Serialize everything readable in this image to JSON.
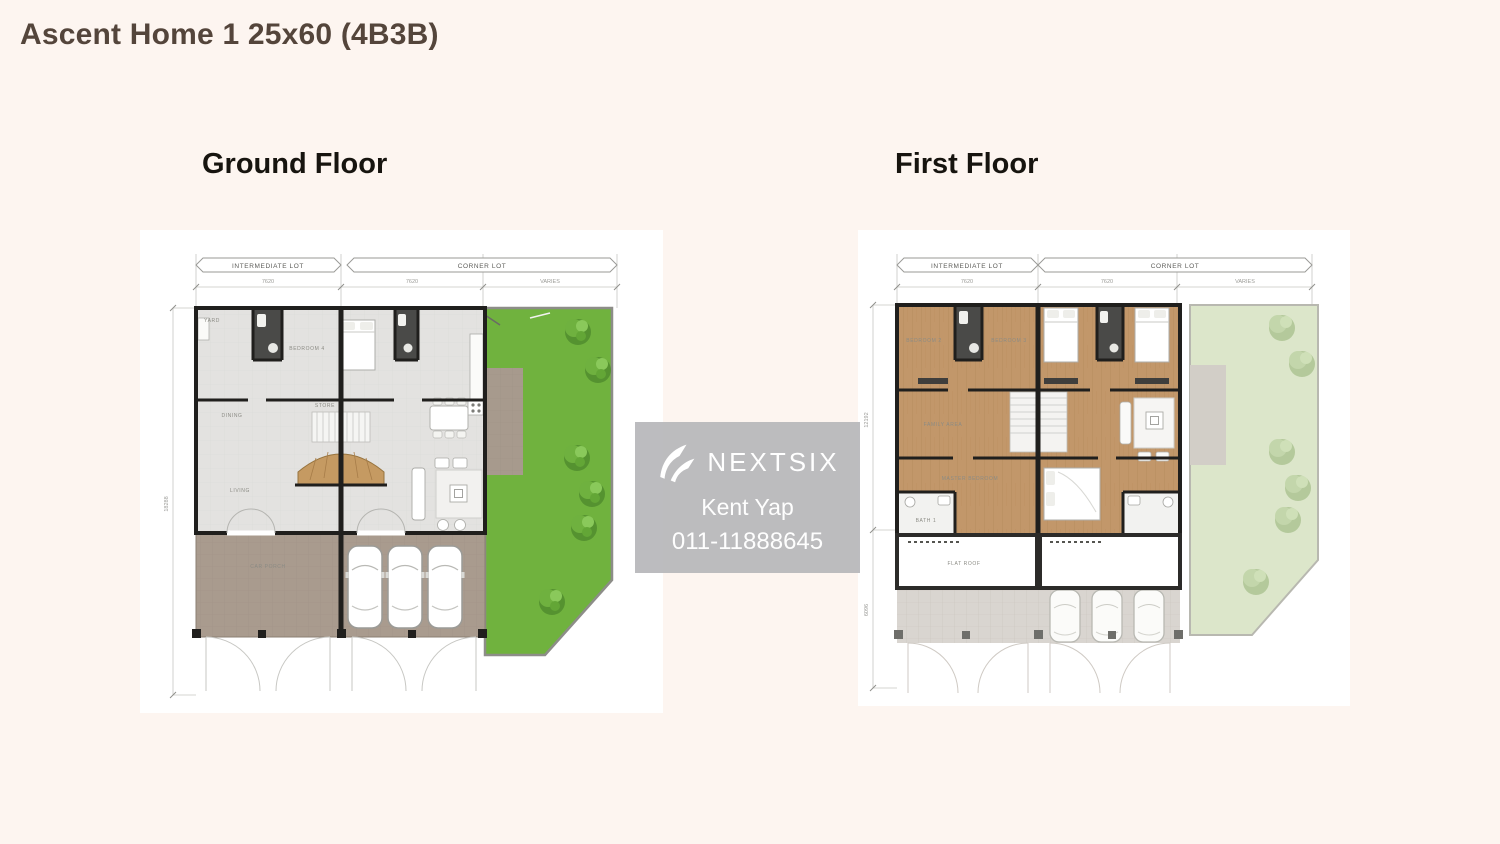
{
  "page": {
    "title": "Ascent Home 1 25x60 (4B3B)"
  },
  "headings": {
    "ground": "Ground Floor",
    "first": "First Floor"
  },
  "plan": {
    "intermediate_lot": "INTERMEDIATE LOT",
    "corner_lot": "CORNER LOT",
    "width_dim": "7620",
    "varies": "VARIES",
    "ground_depth_dim": "18288",
    "first_depth_dim_upper": "12192",
    "first_depth_dim_lower": "6096"
  },
  "ground_rooms": {
    "yard": "YARD",
    "bedroom4": "BEDROOM 4",
    "dining": "DINING",
    "store": "STORE",
    "living": "LIVING",
    "carporch": "CAR PORCH"
  },
  "first_rooms": {
    "bedroom2": "BEDROOM 2",
    "bedroom3": "BEDROOM 3",
    "family": "FAMILY AREA",
    "master": "MASTER BEDROOM",
    "bath1": "BATH 1",
    "flatroof": "FLAT ROOF"
  },
  "watermark": {
    "brand": "NEXTSIX",
    "agent": "Kent Yap",
    "phone": "011-11888645"
  },
  "colors": {
    "background": "#fdf5f0",
    "title": "#54453b",
    "garden": "#70b23e",
    "garden_faded": "#dce6ca",
    "wood": "#c2976a",
    "porch": "#a99b8e",
    "wall": "#201f1d",
    "bath_dark": "#4a4a48",
    "watermark_bg": "#b7b7ba"
  }
}
